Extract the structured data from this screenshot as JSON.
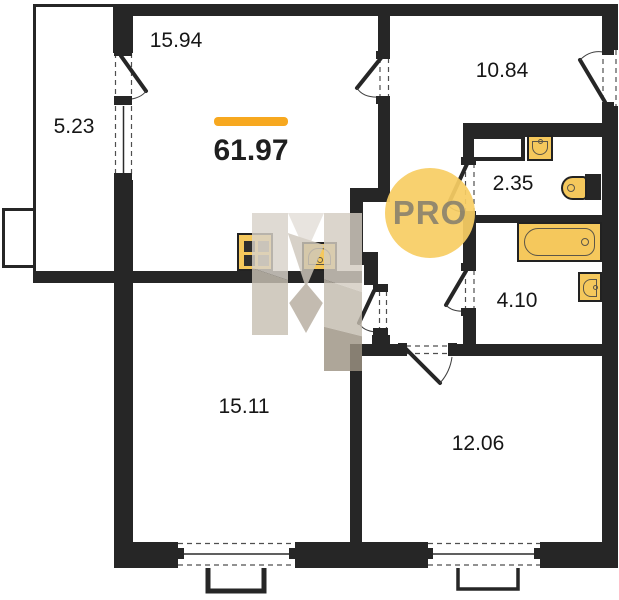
{
  "plan": {
    "total_area": "61.97",
    "watermark_badge": "PRO",
    "rooms": {
      "kitchen_living": {
        "area": "15.94"
      },
      "balcony": {
        "area": "5.23"
      },
      "hallway": {
        "area": "10.84"
      },
      "toilet": {
        "area": "2.35"
      },
      "bathroom": {
        "area": "4.10"
      },
      "bedroom": {
        "area": "15.11"
      },
      "bedroom2": {
        "area": "12.06"
      }
    },
    "colors": {
      "wall": "#262626",
      "fixture_fill": "#F5C85C",
      "accent_bar": "#F7A81F",
      "pro_circle": "rgba(247,206,100,0.93)"
    }
  }
}
